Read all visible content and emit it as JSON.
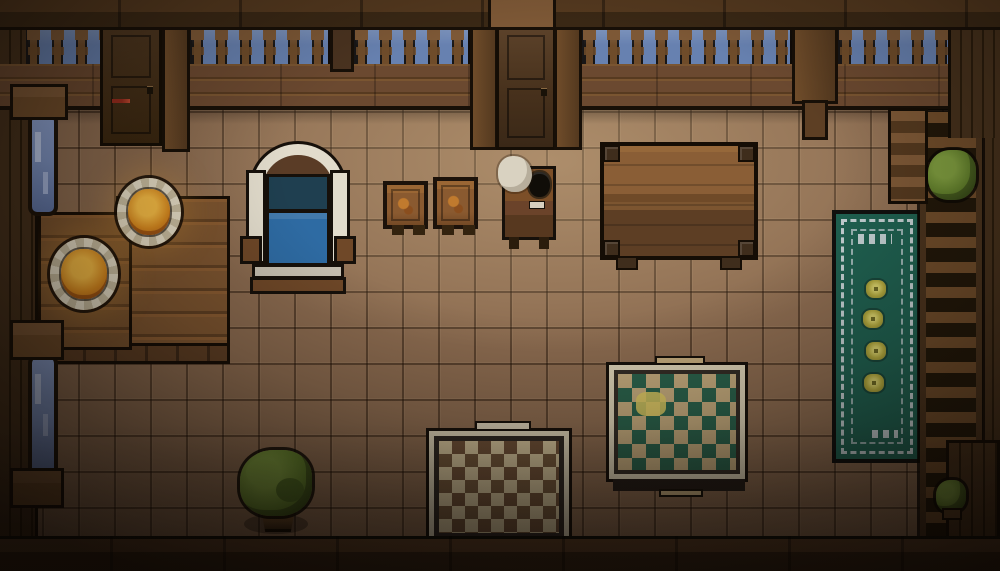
{
  "scene": {
    "title": "Top-down pixel-art tavern room at night",
    "style": "pixel-art",
    "time_of_day": "night"
  },
  "palette": {
    "outline": "#16100a",
    "wallDark": "#3f2d1a",
    "wallPlank": "#46311c",
    "beam": "#6f4c2a",
    "beamLight": "#7d5836",
    "sky": "#6781b0",
    "door": "#47311c",
    "floor": "#8a6a4f",
    "floorLight": "#a58162",
    "tableWood": "#7d5530",
    "tableWoodDark": "#5d3e24",
    "plate": "#e6ddc6",
    "food": "#d98a1f",
    "foodGlow": "#f6bc45",
    "bedFrame": "#e2dccc",
    "bedNavy": "#1f3f50",
    "bedBlue": "#2e6ba3",
    "crate": "#8a5a30",
    "smoke": "#d9d2c1",
    "rugGreen": "#1f6050",
    "rugPale": "#c2ced0",
    "flower": "#b3aa3f",
    "rugTan": "#c2a97c",
    "rugDiamondGreen": "#2a614b",
    "rugCream": "#d9cfb4",
    "checkBrown": "#6f5138",
    "leaf": "#5f7d2a",
    "leafLight": "#7e9c3f",
    "pot": "#5c4023",
    "glass": "#7d93c2"
  },
  "objects": {
    "door_left": {
      "label": "Wooden door (closed)"
    },
    "door_center": {
      "label": "Wooden door (closed)"
    },
    "railing": {
      "label": "Balcony railing over night sky",
      "sections": 5
    },
    "window_upper_left": {
      "label": "Tall window"
    },
    "window_lower_left": {
      "label": "Tall window"
    },
    "stool_upper": {
      "label": "Wall-mounted seat"
    },
    "stool_lower": {
      "label": "Wall-mounted seat"
    },
    "dining_table": {
      "label": "Large plank dining table"
    },
    "bench": {
      "label": "Wooden bench"
    },
    "plate_1": {
      "label": "Plate of warm food"
    },
    "plate_2": {
      "label": "Plate of warm food"
    },
    "bed": {
      "label": "Bed with blue blanket"
    },
    "crate_1": {
      "label": "Wooden crate"
    },
    "crate_2": {
      "label": "Wooden crate"
    },
    "stove": {
      "label": "Small stove with steam"
    },
    "table_top_right": {
      "label": "Wooden table"
    },
    "rug_runner": {
      "label": "Green runner rug",
      "flower_motifs": 4
    },
    "rug_diamond": {
      "label": "Diamond-pattern rug"
    },
    "rug_checkered": {
      "label": "Checkered rug"
    },
    "plant_large": {
      "label": "Potted bush"
    },
    "shelf_plant": {
      "label": "Plant on shelf"
    },
    "small_plant": {
      "label": "Small potted plant"
    },
    "shelf": {
      "label": "Wooden shelf unit"
    },
    "ladder": {
      "label": "Wooden shelf ladder"
    }
  }
}
